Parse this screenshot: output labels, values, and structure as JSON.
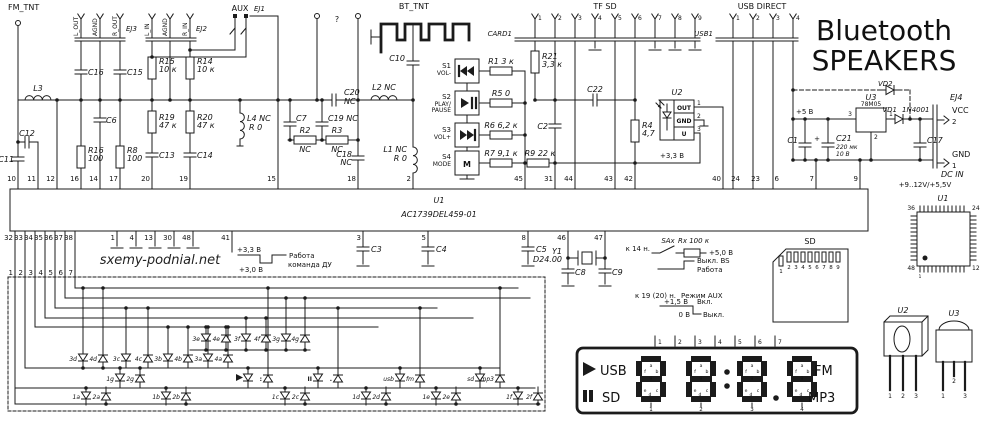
{
  "title": {
    "l1": "Bluetooth",
    "l2": "SPEAKERS"
  },
  "wm": "sxemy-podnial.net",
  "hdr": {
    "fm": "FM_TNT",
    "bt": "BT_TNT",
    "tf": "TF  SD",
    "usb": "USB DIRECT",
    "card1": "CARD1",
    "usb1": "USB1",
    "aux": "AUX",
    "ej1": "EJ1",
    "ej2": "EJ2",
    "ej3": "EJ3",
    "q": "?",
    "ej3p": [
      "L_OUT",
      "AGND",
      "R_OUT"
    ],
    "ej2p": [
      "L_IN",
      "AGND",
      "R_IN"
    ],
    "tfp": [
      "1",
      "2",
      "3",
      "4",
      "5",
      "6",
      "7",
      "8",
      "9"
    ],
    "usbp": [
      "1",
      "2",
      "3",
      "4"
    ]
  },
  "cmp": {
    "l3": "L3",
    "c11": "C11",
    "c12": "C12",
    "c16": "C16",
    "c15": "C15",
    "c6": "C6",
    "r16": "R16",
    "r16v": "100",
    "r8": "R8",
    "r8v": "100",
    "r15": "R15",
    "r15v": "10 к",
    "r14": "R14",
    "r14v": "10 к",
    "r19": "R19",
    "r19v": "47 к",
    "r20": "R20",
    "r20v": "47 к",
    "c13": "C13",
    "c14": "C14",
    "l4": "L4 NC",
    "l4v": "R 0",
    "c7": "C7",
    "r2": "R2",
    "r2v": "NC",
    "c19": "C19 NC",
    "c20": "C20",
    "c20v": "NC",
    "r3": "R3",
    "r3v": "NC",
    "c18": "C18",
    "c18v": "NC",
    "c10": "C10",
    "l2": "L2 NC",
    "l1": "L1 NC",
    "l1v": "R 0",
    "s1": "S1",
    "s1f": "VOL-",
    "s2": "S2",
    "s2f1": "PLAY/",
    "s2f2": "PAUSE",
    "s3": "S3",
    "s3f": "VOL+",
    "s4": "S4",
    "s4f": "MODE",
    "s4m": "M",
    "r1": "R1  3 к",
    "r5": "R5  0",
    "r6": "R6  6,2 к",
    "r7": "R7  9,1 к",
    "r9": "R9  22 к",
    "r21": "R21",
    "r21v": "3,3 к",
    "c2": "C2",
    "c22": "C22",
    "r4": "R4",
    "r4v": "4,7",
    "u2": "U2",
    "u2p1": "OUT",
    "u2p2": "GND",
    "u2p3": "U",
    "v33": "+3,3 В",
    "v5": "+5 В",
    "u3": "U3",
    "u3v": "78M05",
    "vd1": "VD1",
    "vd1v": "1N4001",
    "vd2": "VD2",
    "c21": "C21",
    "c21a": "220 мк",
    "c21b": "10 В",
    "plus": "+",
    "c1": "C1",
    "c17": "C17",
    "ej4": "EJ4",
    "vcc": "VCC",
    "gnd": "GND",
    "dcin": "DC IN",
    "dcv": "+9..12V/+5,5V",
    "c3": "C3",
    "c4": "C4",
    "c5": "C5",
    "c8": "C8",
    "c9": "C9",
    "y1": "Y1",
    "y1v": "D24.00"
  },
  "u1": {
    "name": "U1",
    "part": "AC1739DEL459-01",
    "top": [
      "10",
      "11",
      "12",
      "16",
      "14",
      "17",
      "20",
      "19",
      "15",
      "18",
      "2",
      "45",
      "31",
      "44",
      "43",
      "42",
      "40",
      "24",
      "23",
      "6",
      "7",
      "9"
    ],
    "bot": [
      "32",
      "33",
      "34",
      "35",
      "36",
      "37",
      "38",
      "1",
      "4",
      "13",
      "30",
      "48",
      "41",
      "3",
      "5",
      "8",
      "46",
      "47"
    ]
  },
  "ann1": {
    "v1": "+3,3 В",
    "t1": "Работа",
    "v2": "+3,0 В",
    "t2": "команда ДУ"
  },
  "ann2": {
    "to": "к 14 н.",
    "sw": "SAx",
    "rx": "Rx  100 к",
    "v": "+5,0 В",
    "off": "Выкл. BS",
    "on": "Работа"
  },
  "ann3": {
    "to": "к 19 (20) н.",
    "md": "Режим AUX",
    "hi": "+1,5 В",
    "on": "Вкл.",
    "lo": "0 В",
    "off": "Выкл."
  },
  "sdc": {
    "t": "SD",
    "p": [
      "1",
      "2",
      "3",
      "4",
      "5",
      "6",
      "7",
      "8",
      "9"
    ]
  },
  "qfp": {
    "t": "U1",
    "a": "36",
    "b": "24",
    "c": "48",
    "d": "12",
    "e": "1"
  },
  "p2": {
    "t": "U2",
    "p": [
      "1",
      "2",
      "3"
    ]
  },
  "p3": {
    "t": "U3",
    "p": [
      "1",
      "2",
      "3"
    ]
  },
  "disp": {
    "usb": "USB",
    "sd": "SD",
    "fm": "FM",
    "mp3": "MP3",
    "seg": {
      "a": "a",
      "b": "b",
      "c": "c",
      "d": "d",
      "e": "e",
      "f": "f",
      "g": "g"
    },
    "dn": [
      "1",
      "2",
      "3",
      "4"
    ],
    "pin": [
      "1",
      "2",
      "3",
      "4",
      "5",
      "6",
      "7"
    ]
  },
  "mx": {
    "a": [
      "3e",
      "4e",
      "3f",
      "4f",
      "3g",
      "4g"
    ],
    "b": [
      "3d",
      "4d",
      "3c",
      "4c",
      "3b",
      "4b",
      "3a",
      "4a"
    ],
    "g": [
      "1g",
      "2g"
    ],
    "d": [
      "1a",
      "2a",
      "1b",
      "2b",
      "1c",
      "2c",
      "1d",
      "2d",
      "1e",
      "2e",
      "1f",
      "2f"
    ],
    "ic": [
      "usb",
      "fm",
      "sd",
      "mp3"
    ],
    "ps": "II",
    "cl": ":",
    "dot": ".",
    "conn": [
      "1",
      "2",
      "3",
      "4",
      "5",
      "6",
      "7"
    ]
  }
}
